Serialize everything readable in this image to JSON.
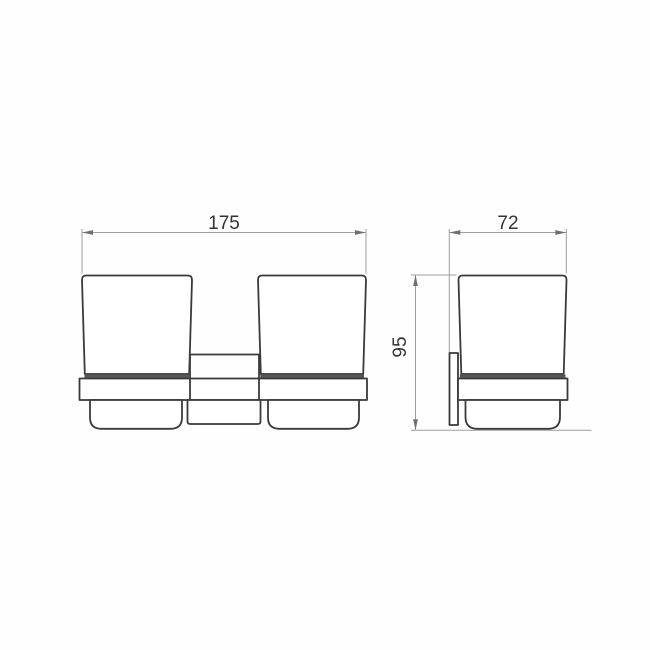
{
  "drawing": {
    "title": "double-tumbler-holder-dimension-drawing",
    "units_shown": false,
    "front_view": {
      "width_label": "175"
    },
    "side_view": {
      "depth_label": "72",
      "height_label": "95"
    },
    "colors": {
      "background": "#fefefe",
      "object_line": "#3a3a3a",
      "rim_line": "#575757",
      "dimension_line": "#9e9e9e",
      "arrow": "#6f6f6f",
      "text": "#333333"
    }
  }
}
